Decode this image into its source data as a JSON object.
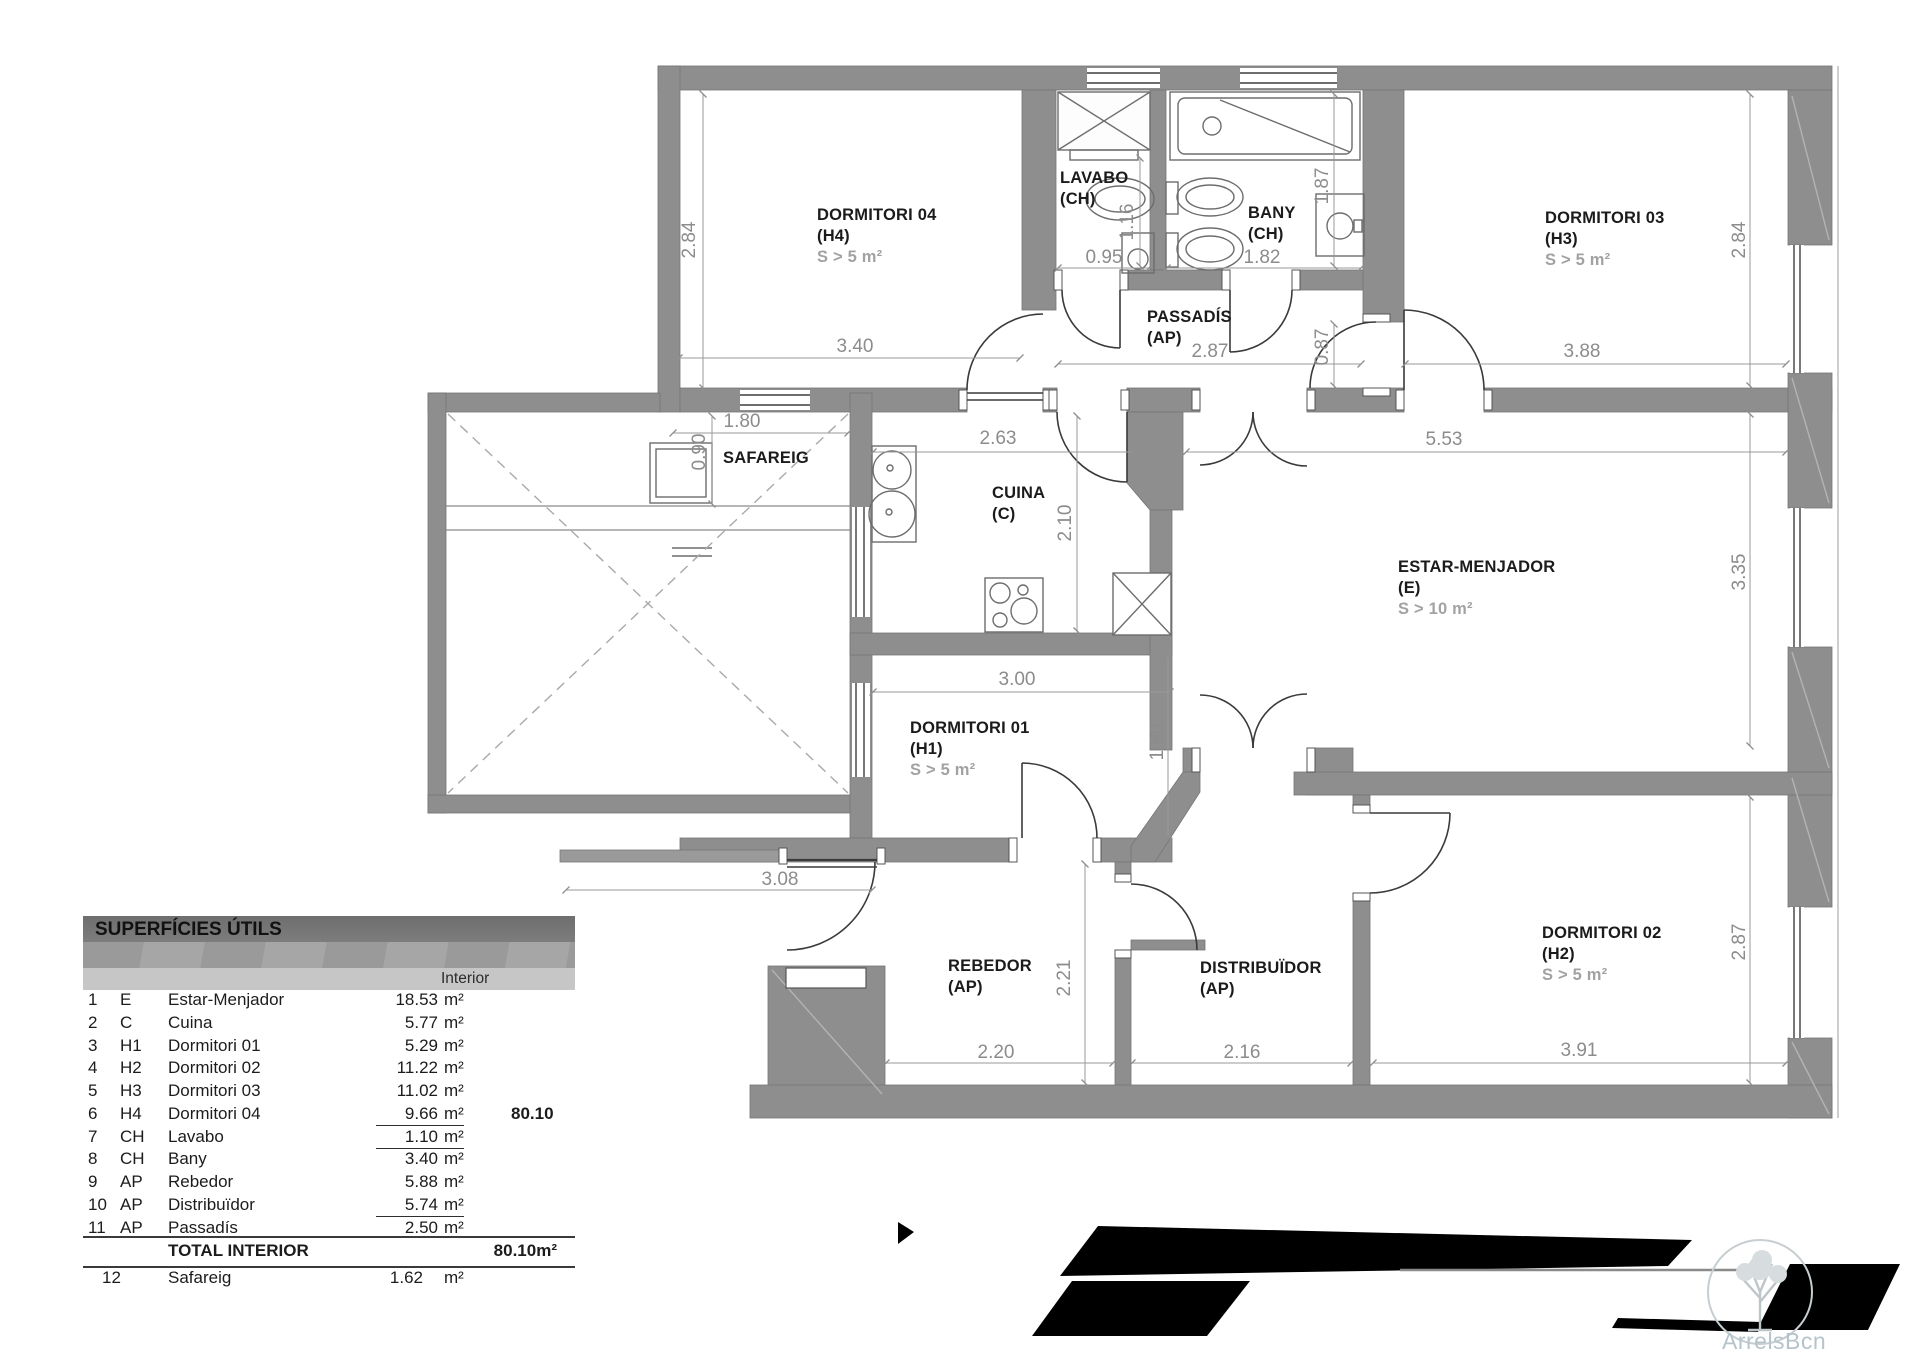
{
  "plan": {
    "rooms": {
      "dormitori04": {
        "name": "DORMITORI 04",
        "code": "(H4)",
        "note": "S > 5 m²"
      },
      "lavabo": {
        "name": "LAVABO",
        "code": "(CH)"
      },
      "bany": {
        "name": "BANY",
        "code": "(CH)"
      },
      "passadis": {
        "name": "PASSADÍS",
        "code": "(AP)"
      },
      "dormitori03": {
        "name": "DORMITORI 03",
        "code": "(H3)",
        "note": "S > 5 m²"
      },
      "safareig": {
        "name": "SAFAREIG"
      },
      "cuina": {
        "name": "CUINA",
        "code": "(C)"
      },
      "estar": {
        "name": "ESTAR-MENJADOR",
        "code": "(E)",
        "note": "S > 10 m²"
      },
      "dormitori01": {
        "name": "DORMITORI 01",
        "code": "(H1)",
        "note": "S > 5 m²"
      },
      "rebedor": {
        "name": "REBEDOR",
        "code": "(AP)"
      },
      "distribuidor": {
        "name": "DISTRIBUÏDOR",
        "code": "(AP)"
      },
      "dormitori02": {
        "name": "DORMITORI 02",
        "code": "(H2)",
        "note": "S > 5 m²"
      }
    },
    "dims": {
      "d04_w": "3.40",
      "d04_h": "2.84",
      "lavabo_w": "0.95",
      "lavabo_d": "1.16",
      "bany_w": "1.82",
      "bany_d": "1.87",
      "passadis_w": "2.87",
      "passadis_d": "0.87",
      "d03_w": "3.88",
      "d03_h": "2.84",
      "safareig_w": "1.80",
      "safareig_d": "0.90",
      "cuina_w": "2.63",
      "cuina_d": "2.10",
      "estar_w": "5.53",
      "estar_h": "3.35",
      "d01_w": "3.00",
      "d01_h": "1.80",
      "entry_w": "3.08",
      "rebedor_d": "2.21",
      "rebedor_w": "2.20",
      "distribuidor_w": "2.16",
      "d02_w": "3.91",
      "d02_h": "2.87"
    }
  },
  "table": {
    "title": "SUPERFÍCIES ÚTILS",
    "column": "Interior",
    "rows": [
      {
        "num": "1",
        "code": "E",
        "name": "Estar-Menjador",
        "area": "18.53",
        "unit": "m²"
      },
      {
        "num": "2",
        "code": "C",
        "name": "Cuina",
        "area": "5.77",
        "unit": "m²"
      },
      {
        "num": "3",
        "code": "H1",
        "name": "Dormitori 01",
        "area": "5.29",
        "unit": "m²"
      },
      {
        "num": "4",
        "code": "H2",
        "name": "Dormitori 02",
        "area": "11.22",
        "unit": "m²"
      },
      {
        "num": "5",
        "code": "H3",
        "name": "Dormitori 03",
        "area": "11.02",
        "unit": "m²"
      },
      {
        "num": "6",
        "code": "H4",
        "name": "Dormitori 04",
        "area": "9.66",
        "unit": "m²",
        "extra": "80.10"
      },
      {
        "num": "7",
        "code": "CH",
        "name": "Lavabo",
        "area": "1.10",
        "unit": "m²"
      },
      {
        "num": "8",
        "code": "CH",
        "name": "Bany",
        "area": "3.40",
        "unit": "m²"
      },
      {
        "num": "9",
        "code": "AP",
        "name": "Rebedor",
        "area": "5.88",
        "unit": "m²"
      },
      {
        "num": "10",
        "code": "AP",
        "name": "Distribuïdor",
        "area": "5.74",
        "unit": "m²"
      },
      {
        "num": "11",
        "code": "AP",
        "name": "Passadís",
        "area": "2.50",
        "unit": "m²"
      }
    ],
    "total": {
      "label": "TOTAL INTERIOR",
      "value": "80.10m²"
    },
    "extra_row": {
      "num": "12",
      "name": "Safareig",
      "area": "1.62",
      "unit": "m²"
    }
  },
  "watermark": {
    "text": "ArrelsBcn"
  },
  "colors": {
    "wall": "#8e8e8e",
    "dim_text": "#8c8c8c",
    "label_text": "#1b1b1b",
    "note_text": "#a2a2a2",
    "redaction": "#000000",
    "watermark": "#b5c4ca"
  }
}
